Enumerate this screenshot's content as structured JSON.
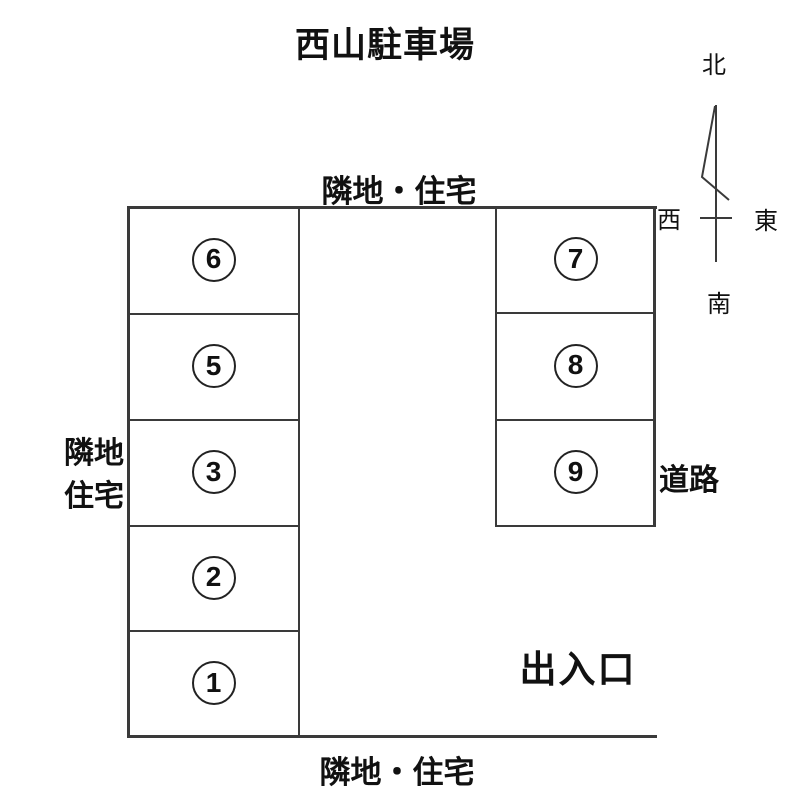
{
  "title": "西山駐車場",
  "compass": {
    "north": "北",
    "south": "南",
    "east": "東",
    "west": "西"
  },
  "surroundings": {
    "top": "隣地・住宅",
    "bottom": "隣地・住宅",
    "left_line1": "隣地",
    "left_line2": "住宅",
    "right": "道路"
  },
  "entrance_label": "出入口",
  "stalls": {
    "left": [
      "6",
      "5",
      "3",
      "2",
      "1"
    ],
    "right": [
      "7",
      "8",
      "9"
    ]
  },
  "colors": {
    "line": "#3a3a3a",
    "text": "#111111",
    "background": "#ffffff"
  }
}
